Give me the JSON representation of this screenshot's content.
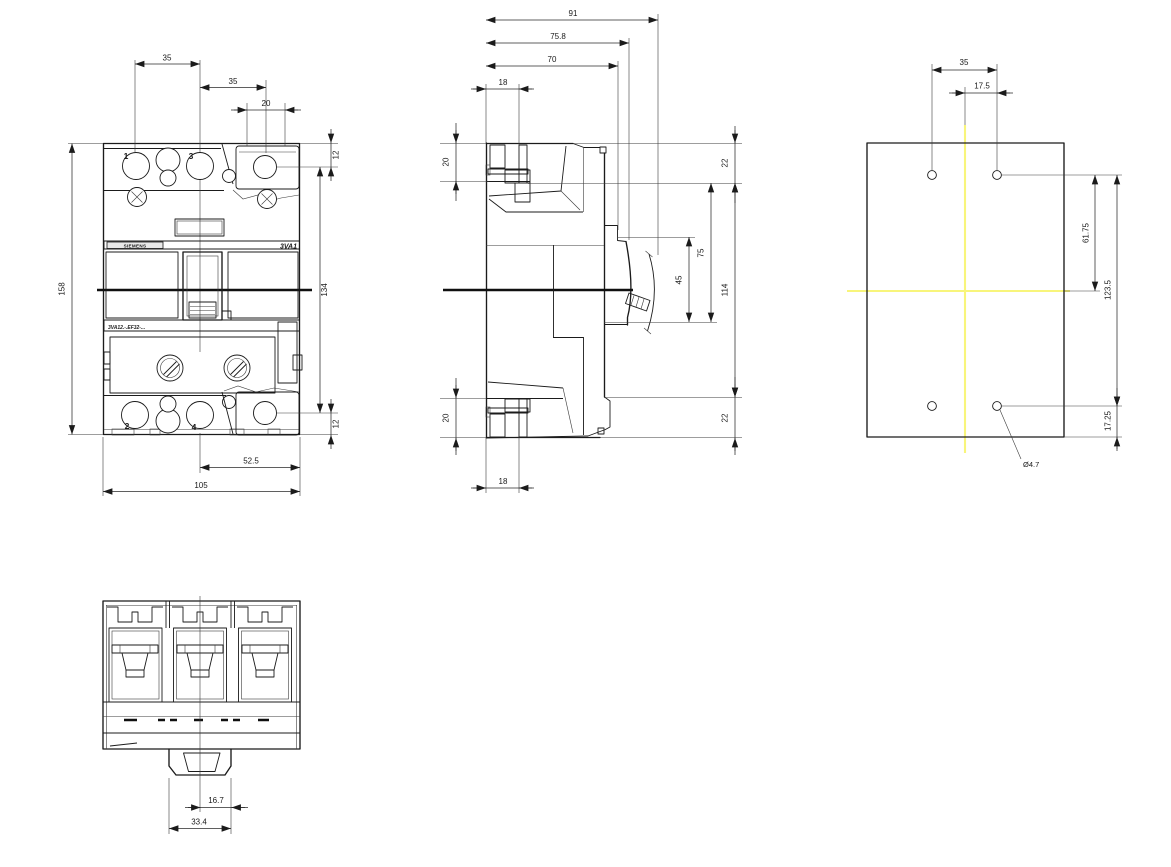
{
  "drawing": {
    "colors": {
      "line": "#1b1b1b",
      "centerline_yellow": "#f8f57b"
    },
    "views": {
      "front": {
        "pole_labels": {
          "p1": "1",
          "p3": "3",
          "p2": "2",
          "p4": "4"
        },
        "brand": "SIEMENS",
        "series": "3VA1",
        "type_code": "3VA12.-.EF32-...",
        "dims": {
          "pole_pitch_left": "35",
          "pole_pitch_right": "35",
          "aux_width": "20",
          "aux_top_offset": "12",
          "inner_height": "134",
          "height": "158",
          "aux_bottom_offset": "12",
          "half_width_right": "52.5",
          "width": "105"
        }
      },
      "side": {
        "dims": {
          "depth_total": "91",
          "depth_rear_to_cover": "75.8",
          "depth_rear_to_front": "70",
          "terminal_depth_top": "18",
          "terminal_height_top": "20",
          "top_to_shelf": "22",
          "cover_height": "75",
          "handle_window_height": "45",
          "mid_height": "114",
          "bottom_shelf": "22",
          "terminal_height_bottom": "20",
          "terminal_depth_bottom": "18"
        }
      },
      "drilling": {
        "dims": {
          "hole_pitch": "35",
          "hole_half_pitch": "17.5",
          "hole_to_centerline": "61.75",
          "hole_vertical_pitch": "123.5",
          "hole_bottom_offset": "17.25",
          "hole_diameter": "Ø4.7"
        }
      },
      "bottom": {
        "dims": {
          "handle_half_width": "16.7",
          "handle_cutout_width": "33.4"
        }
      }
    }
  }
}
